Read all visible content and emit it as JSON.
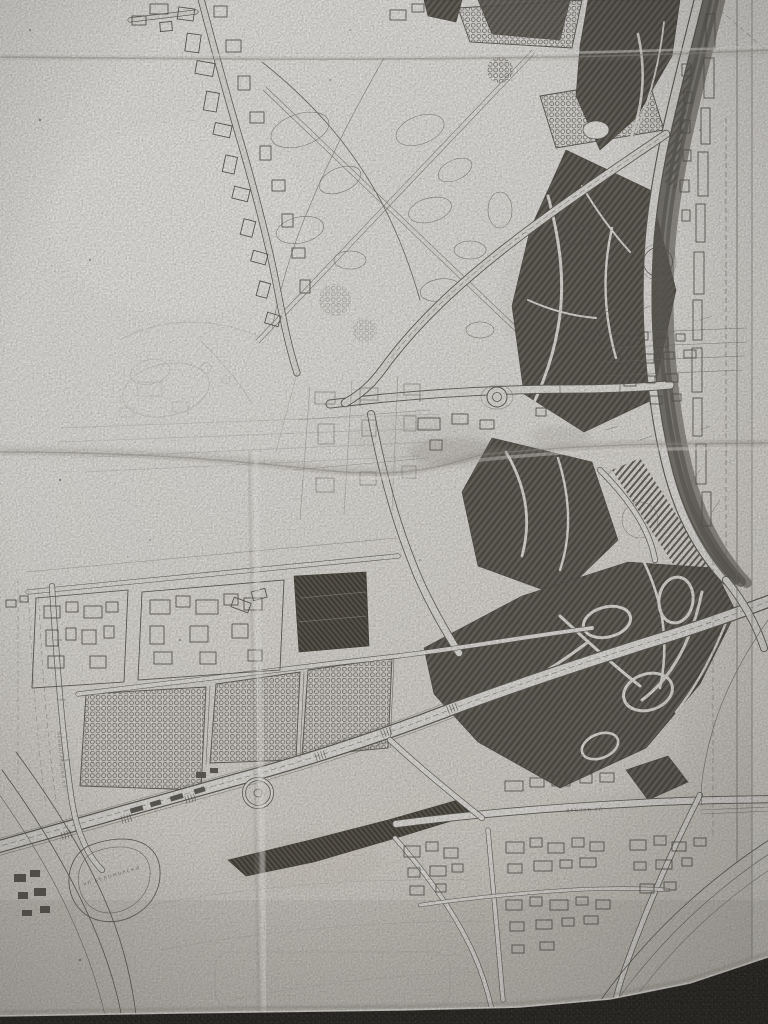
{
  "photo": {
    "description": "Overhead photograph of a folded paper urban master-plan drawing (black ink on aged light-grey paper)",
    "surface_below": "dark carpet visible along the bottom edge of the sheet"
  },
  "map": {
    "labels": {
      "street_left_vertical": "ЛЕНИНГРАДСКА УЛ",
      "street_diagonal": "УЛ БЕЛОМОРСКИ",
      "street_bottom_horizontal": "ДРЪЗКИ УЛ"
    },
    "features": [
      "large park with dark hatched tree masses and winding footpaths",
      "orchard / garden blocks drawn with circle pattern",
      "major boulevard interchange with loop ramps",
      "riverside boulevard with parallel tram lines",
      "old-town irregular building blocks",
      "roundabouts",
      "fold creases of the sheet"
    ],
    "colors": {
      "paper": "#d6d5d1",
      "ink": "#54524d",
      "tree_mass": "#55534d",
      "carpet": "#23221f"
    }
  }
}
